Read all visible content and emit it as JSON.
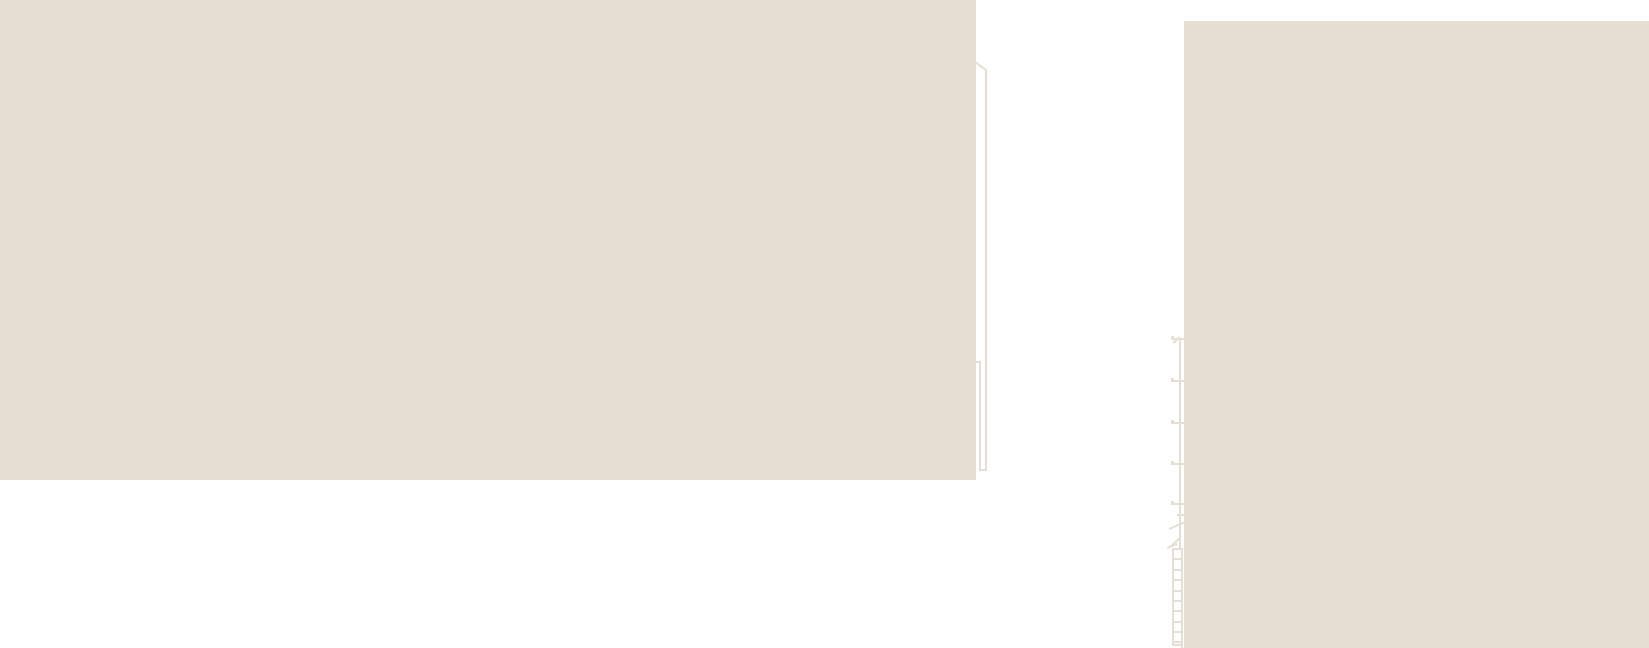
{
  "canvas": {
    "width": 1649,
    "height": 648,
    "background_color": "#ffffff",
    "ink_color": "#e5ded2"
  },
  "shapes": [
    {
      "name": "left-building-face",
      "type": "rect",
      "x": 0,
      "y": 0,
      "w": 976,
      "h": 480
    },
    {
      "name": "right-building-face",
      "type": "rect",
      "x": 1184,
      "y": 21,
      "w": 465,
      "h": 627
    },
    {
      "name": "pole-outer-line",
      "type": "rect",
      "x": 985,
      "y": 69,
      "w": 2,
      "h": 402
    },
    {
      "name": "pole-inner-line",
      "type": "rect",
      "x": 979,
      "y": 362,
      "w": 2,
      "h": 109
    },
    {
      "name": "pole-top-stub",
      "type": "rect",
      "x": 976,
      "y": 361,
      "w": 5,
      "h": 2
    },
    {
      "name": "pole-base-bar",
      "type": "rect",
      "x": 979,
      "y": 469,
      "w": 8,
      "h": 2
    },
    {
      "name": "pole-cap-diagonal",
      "type": "line",
      "x1": 975,
      "y1": 62,
      "x2": 986,
      "y2": 70,
      "t": 2
    },
    {
      "name": "mast-line",
      "type": "rect",
      "x": 1179,
      "y": 338,
      "w": 2,
      "h": 210
    },
    {
      "name": "mast-tip-diagonal",
      "type": "line",
      "x1": 1173,
      "y1": 343,
      "x2": 1180,
      "y2": 337,
      "t": 1.5
    },
    {
      "name": "mast-tick",
      "type": "rect",
      "x": 1171,
      "y": 338,
      "w": 13,
      "h": 2
    },
    {
      "name": "mast-tick-nub",
      "type": "rect",
      "x": 1171,
      "y": 336,
      "w": 3,
      "h": 2
    },
    {
      "name": "mast-tick",
      "type": "rect",
      "x": 1171,
      "y": 380,
      "w": 13,
      "h": 2
    },
    {
      "name": "mast-tick-nub",
      "type": "rect",
      "x": 1171,
      "y": 378,
      "w": 3,
      "h": 2
    },
    {
      "name": "mast-tick",
      "type": "rect",
      "x": 1171,
      "y": 422,
      "w": 13,
      "h": 2
    },
    {
      "name": "mast-tick-nub",
      "type": "rect",
      "x": 1171,
      "y": 420,
      "w": 3,
      "h": 2
    },
    {
      "name": "mast-tick",
      "type": "rect",
      "x": 1171,
      "y": 463,
      "w": 13,
      "h": 2
    },
    {
      "name": "mast-tick-nub",
      "type": "rect",
      "x": 1171,
      "y": 461,
      "w": 3,
      "h": 2
    },
    {
      "name": "mast-tick",
      "type": "rect",
      "x": 1171,
      "y": 503,
      "w": 13,
      "h": 2
    },
    {
      "name": "mast-tick-nub",
      "type": "rect",
      "x": 1171,
      "y": 501,
      "w": 3,
      "h": 2
    },
    {
      "name": "mast-stub",
      "type": "rect",
      "x": 1177,
      "y": 514,
      "w": 8,
      "h": 2
    },
    {
      "name": "break-diagonal-upper",
      "type": "line",
      "x1": 1169,
      "y1": 529,
      "x2": 1185,
      "y2": 522,
      "t": 1.5
    },
    {
      "name": "break-diagonal-mid",
      "type": "line",
      "x1": 1171,
      "y1": 546,
      "x2": 1181,
      "y2": 537,
      "t": 1.5
    },
    {
      "name": "break-diagonal-lower",
      "type": "line",
      "x1": 1167,
      "y1": 548,
      "x2": 1177,
      "y2": 544,
      "t": 1.5
    },
    {
      "name": "ladder-left-rail",
      "type": "rect",
      "x": 1172,
      "y": 548,
      "w": 2,
      "h": 98
    },
    {
      "name": "ladder-right-rail",
      "type": "rect",
      "x": 1181,
      "y": 548,
      "w": 2,
      "h": 100
    },
    {
      "name": "ladder-rung",
      "type": "rect",
      "x": 1172,
      "y": 548,
      "w": 11,
      "h": 2
    },
    {
      "name": "ladder-rung",
      "type": "rect",
      "x": 1172,
      "y": 558,
      "w": 11,
      "h": 2
    },
    {
      "name": "ladder-rung",
      "type": "rect",
      "x": 1172,
      "y": 569,
      "w": 11,
      "h": 2
    },
    {
      "name": "ladder-rung",
      "type": "rect",
      "x": 1172,
      "y": 579,
      "w": 11,
      "h": 2
    },
    {
      "name": "ladder-rung",
      "type": "rect",
      "x": 1172,
      "y": 590,
      "w": 11,
      "h": 2
    },
    {
      "name": "ladder-rung",
      "type": "rect",
      "x": 1172,
      "y": 600,
      "w": 11,
      "h": 2
    },
    {
      "name": "ladder-rung",
      "type": "rect",
      "x": 1172,
      "y": 610,
      "w": 11,
      "h": 2
    },
    {
      "name": "ladder-rung",
      "type": "rect",
      "x": 1172,
      "y": 621,
      "w": 11,
      "h": 2
    },
    {
      "name": "ladder-rung",
      "type": "rect",
      "x": 1172,
      "y": 631,
      "w": 11,
      "h": 2
    },
    {
      "name": "ladder-rung",
      "type": "rect",
      "x": 1172,
      "y": 641,
      "w": 11,
      "h": 2
    },
    {
      "name": "ladder-bottom-bar",
      "type": "rect",
      "x": 1172,
      "y": 644,
      "w": 11,
      "h": 2
    }
  ]
}
